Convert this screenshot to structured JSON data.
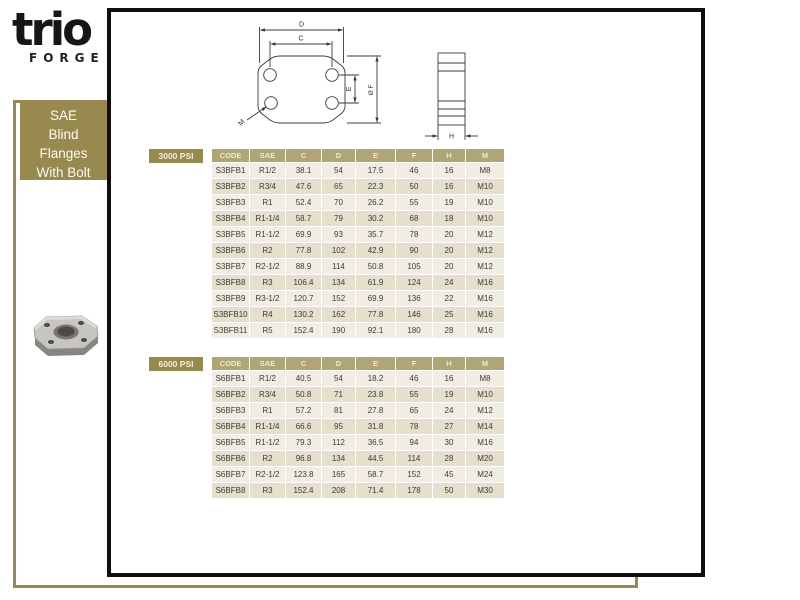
{
  "brand": {
    "logo": "trio",
    "subtitle": "FORGE"
  },
  "sidebar": {
    "lines": [
      "SAE",
      "Blind",
      "Flanges",
      "With Bolt"
    ]
  },
  "diagram": {
    "labels": {
      "d": "D",
      "c": "C",
      "e": "E",
      "f": "Ø F",
      "m": "M",
      "h": "H"
    }
  },
  "tables": [
    {
      "pressure": "3000 PSI",
      "columns": [
        "CODE",
        "SAE",
        "C",
        "D",
        "E",
        "F",
        "H",
        "M"
      ],
      "rows": [
        [
          "S3BFB1",
          "R1/2",
          "38.1",
          "54",
          "17.5",
          "46",
          "16",
          "M8"
        ],
        [
          "S3BFB2",
          "R3/4",
          "47.6",
          "65",
          "22.3",
          "50",
          "16",
          "M10"
        ],
        [
          "S3BFB3",
          "R1",
          "52.4",
          "70",
          "26.2",
          "55",
          "19",
          "M10"
        ],
        [
          "S3BFB4",
          "R1-1/4",
          "58.7",
          "79",
          "30.2",
          "68",
          "18",
          "M10"
        ],
        [
          "S3BFB5",
          "R1-1/2",
          "69.9",
          "93",
          "35.7",
          "78",
          "20",
          "M12"
        ],
        [
          "S3BFB6",
          "R2",
          "77.8",
          "102",
          "42.9",
          "90",
          "20",
          "M12"
        ],
        [
          "S3BFB7",
          "R2-1/2",
          "88.9",
          "114",
          "50.8",
          "105",
          "20",
          "M12"
        ],
        [
          "S3BFB8",
          "R3",
          "106.4",
          "134",
          "61.9",
          "124",
          "24",
          "M16"
        ],
        [
          "S3BFB9",
          "R3-1/2",
          "120.7",
          "152",
          "69.9",
          "136",
          "22",
          "M16"
        ],
        [
          "S3BFB10",
          "R4",
          "130.2",
          "162",
          "77.8",
          "146",
          "25",
          "M16"
        ],
        [
          "S3BFB11",
          "R5",
          "152.4",
          "190",
          "92.1",
          "180",
          "28",
          "M16"
        ]
      ]
    },
    {
      "pressure": "6000 PSI",
      "columns": [
        "CODE",
        "SAE",
        "C",
        "D",
        "E",
        "F",
        "H",
        "M"
      ],
      "rows": [
        [
          "S6BFB1",
          "R1/2",
          "40.5",
          "54",
          "18.2",
          "46",
          "16",
          "M8"
        ],
        [
          "S6BFB2",
          "R3/4",
          "50.8",
          "71",
          "23.8",
          "55",
          "19",
          "M10"
        ],
        [
          "S6BFB3",
          "R1",
          "57.2",
          "81",
          "27.8",
          "65",
          "24",
          "M12"
        ],
        [
          "S6BFB4",
          "R1-1/4",
          "66.6",
          "95",
          "31.8",
          "78",
          "27",
          "M14"
        ],
        [
          "S6BFB5",
          "R1-1/2",
          "79.3",
          "112",
          "36.5",
          "94",
          "30",
          "M16"
        ],
        [
          "S6BFB6",
          "R2",
          "96.8",
          "134",
          "44.5",
          "114",
          "28",
          "M20"
        ],
        [
          "S6BFB7",
          "R2-1/2",
          "123.8",
          "165",
          "58.7",
          "152",
          "45",
          "M24"
        ],
        [
          "S6BFB8",
          "R3",
          "152.4",
          "208",
          "71.4",
          "178",
          "50",
          "M30"
        ]
      ]
    }
  ],
  "colors": {
    "khaki": "#98894f",
    "table_header": "#b1a578",
    "row_light": "#f0ede2",
    "row_dark": "#e5dfcb",
    "panel_border": "#0f0f0f"
  }
}
